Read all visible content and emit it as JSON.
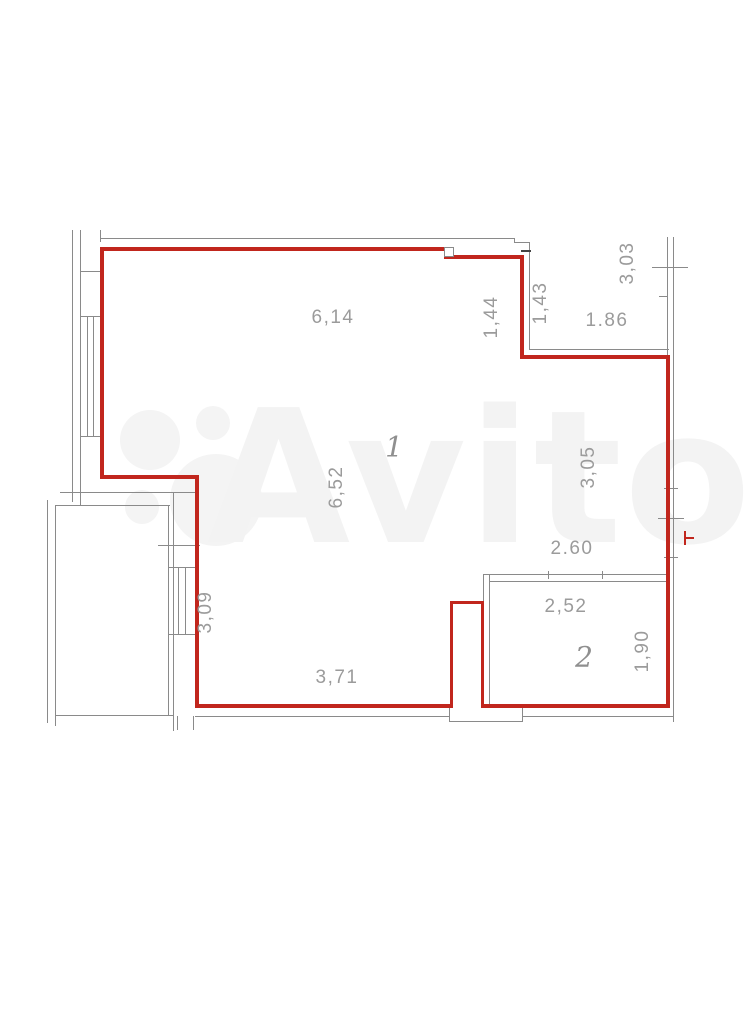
{
  "watermark": {
    "text": "Avito"
  },
  "plan": {
    "rooms": [
      {
        "number": "1"
      },
      {
        "number": "2"
      }
    ],
    "dimensions": [
      {
        "value": "6,14",
        "axis": "horizontal",
        "location": "top-wall"
      },
      {
        "value": "1,44",
        "axis": "vertical",
        "location": "top-step-inner"
      },
      {
        "value": "1,43",
        "axis": "vertical",
        "location": "top-niche-depth"
      },
      {
        "value": "1.86",
        "axis": "horizontal",
        "location": "top-niche-width"
      },
      {
        "value": "3,03",
        "axis": "vertical",
        "location": "right-outer-top"
      },
      {
        "value": "6,52",
        "axis": "vertical",
        "location": "room-1-depth"
      },
      {
        "value": "3,05",
        "axis": "vertical",
        "location": "right-wall-upper"
      },
      {
        "value": "2.60",
        "axis": "horizontal",
        "location": "room-2-outer-width"
      },
      {
        "value": "2,52",
        "axis": "horizontal",
        "location": "room-2-inner-width"
      },
      {
        "value": "1,90",
        "axis": "vertical",
        "location": "room-2-height"
      },
      {
        "value": "3,09",
        "axis": "vertical",
        "location": "left-lower-wall"
      },
      {
        "value": "3,71",
        "axis": "horizontal",
        "location": "bottom-wall"
      }
    ],
    "colors": {
      "red_wall": "#c1261d",
      "gray_line": "#8a8a8a",
      "label_text": "#9b9b9b"
    }
  }
}
